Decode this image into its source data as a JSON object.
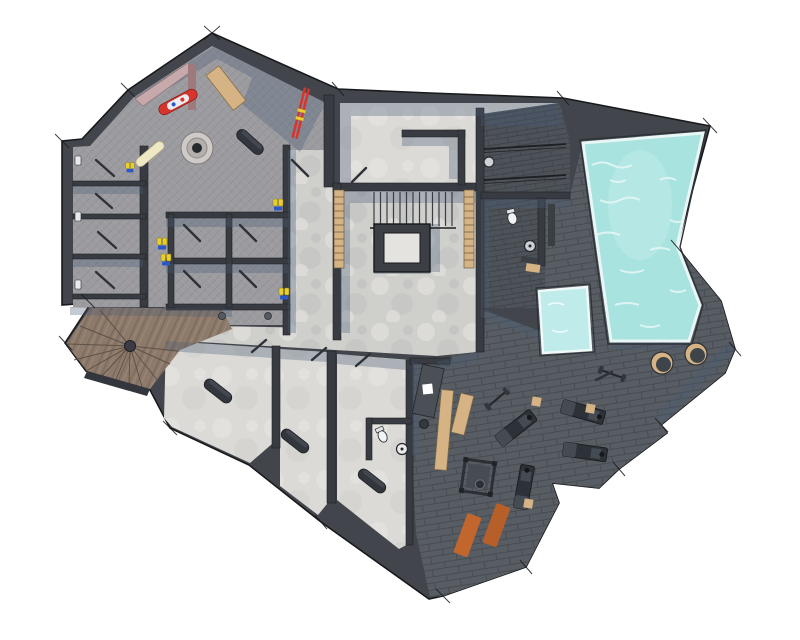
{
  "scene": {
    "kind": "floor-plan-rendering",
    "view": "top-down"
  },
  "palette": {
    "bg": "#ffffff",
    "wall": "#42464c",
    "wall_dark": "#383c42",
    "outline": "#17191b",
    "ski_tile": "#9c9ca0",
    "concrete": "#cfcfcc",
    "room_light": "#dbdad6",
    "void_light": "#e4e3e0",
    "slate": "#585d64",
    "slate_dark": "#4e535a",
    "water": "#a9e3e0",
    "water_plunge": "#bfecea",
    "water_rim": "#e8f7f6",
    "wood_tan": "#d5b384",
    "wood_floor": "#8d7a6a",
    "mauve": "#c7a9ab",
    "mauve_dark": "#9e7a7c",
    "orange_mat": "#c1662c",
    "orange_mat2": "#b65f28",
    "red": "#d9342b",
    "cream": "#efe8c4",
    "yellow": "#e8cf2e",
    "boot_blue": "#2c57c9",
    "dark_object": "#33373d",
    "shadow": "#4a5c76",
    "fixture_white": "#f2f3f4"
  },
  "inventory": {
    "rooms": [
      "ski-room",
      "storage-stalls",
      "changing-cubicles",
      "corridor",
      "stair-hall",
      "stairwell-void",
      "upper-room",
      "pool-vestibule",
      "pool-bathroom",
      "pool-deck",
      "swimming-pool",
      "plunge-pool",
      "gym",
      "cellar-room-a",
      "cellar-room-b",
      "cellar-room-c",
      "office-nook",
      "wc",
      "spiral-stair-room"
    ],
    "objects": [
      "snowboard-red",
      "snowboard-cream",
      "red-skis",
      "ski-boots",
      "floor-drain",
      "wood-table",
      "wall-bench",
      "ladder-rack",
      "railing",
      "wall-clock",
      "toilet",
      "sink",
      "bench",
      "barrel-tub",
      "exercise-machine",
      "barbell",
      "squat-rack",
      "yoga-mat",
      "wood-bench",
      "desk",
      "office-chair",
      "cylinder-bolster",
      "spiral-stairs",
      "canister"
    ]
  }
}
